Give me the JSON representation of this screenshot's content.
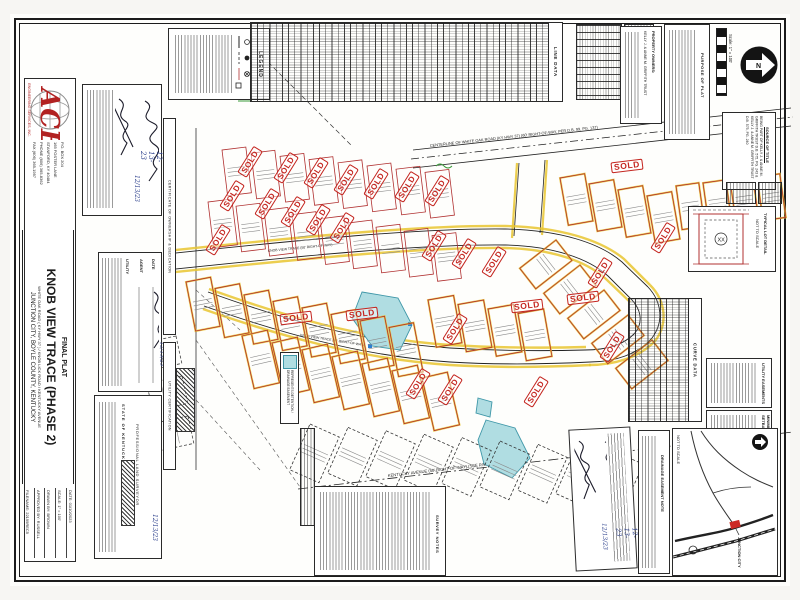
{
  "sheet": {
    "firm": {
      "logo_word": "ACE",
      "name": "ENGINEERING SERVICES, INC.",
      "address_lines": [
        "P.O. BOX 204",
        "165 FOSTER LANE",
        "STANFORD, KY 40484",
        "PHONE (606) 365-8362",
        "FAX (606) 365-1997"
      ]
    },
    "title_block": {
      "line1": "FINAL PLAT",
      "line2": "KNOB VIEW TRACE (PHASE 2)",
      "line3": "WHITE OAK ROAD ( KY HWY 37 ) / KNOB LICK ROAD / KENTUCKY AVENUE",
      "line4": "JUNCTION CITY, BOYLE COUNTY, KENTUCKY"
    },
    "info_block": {
      "date": "DATE: 01/10/2023",
      "scale": "SCALE: 1\" = 100'",
      "drawn": "DRAWN BY: BROWN",
      "approved": "APPROVED BY: RUSSELL",
      "filename": "FILENAME: 22199REC5"
    }
  },
  "certificates": {
    "ownership_strip": "CERTIFICATE OF OWNERSHIP & DEDICATION",
    "utility_strip": "UTILITY CERTIFICATION",
    "owner_date_1": "12-13-23",
    "owner_date_2": "12/13/23",
    "utility_label": "UTILITY",
    "agent_label": "AGENT",
    "date_label": "DATE",
    "surveyor_state": "STATE OF KENTUCKY",
    "surveyor_title": "PROFESSIONAL LAND SURVEYOR",
    "plan_date_1": "12-13-23",
    "plan_date_2": "12/13/23"
  },
  "top": {
    "legend_title": "LEGEND",
    "line_table_title": "LINE DATA",
    "curve_table_title": "CURVE DATA",
    "owners_title": "PROPERTY OWNERS:",
    "owners_name": "KELLY J. & ANNE M. GRIFFITH TRUST",
    "purpose_title": "PURPOSE OF PLAT",
    "scale_label": "Scale: 1\" = 100'",
    "north_letter": "N",
    "source_title": "SOURCE OF TITLE",
    "source_lines": "BEING PART OF  KELLY J. & ANNE M. GRIFFITH TRUST  D.B. 575, PG. 243  &  KELLY J. & ANNE M. GRIFFITH TRUST  D.B. 575, PG. 240"
  },
  "map": {
    "sold_label": "SOLD",
    "white_oak_label": "CENTERLINE OF WHITE OAK ROAD  (KY HWY 37)  (60' RIGHT-OF-WAY, PER D.B. 99, PG. 137)",
    "kentucky_ave_label": "KENTUCKY AVENUE  (50' RIGHT-OF-WAY)  (SEE R/W NOTE )",
    "street_label": "KNOB VIEW TRACE (50' RIGHT-OF-WAY)",
    "pond_legend": "REPRESENTS DETENTION / DRAINAGE EASEMENT"
  },
  "right": {
    "lot_detail_title": "TYPICAL LOT DETAIL",
    "lot_detail_scale": "NOT TO SCALE",
    "lot_detail_marker": "XX",
    "easement_box_title": "UTILITY EASEMENTS",
    "setback_box_title": "MINIMUM SETBACKS",
    "drainage_note_title": "DRAINAGE EASEMENT NOTE"
  },
  "bottom": {
    "survey_notes_title": "SURVEY NOTES",
    "vicinity_scale": "NOT TO SCALE",
    "vicinity_city": "JUNCTION CITY"
  }
}
